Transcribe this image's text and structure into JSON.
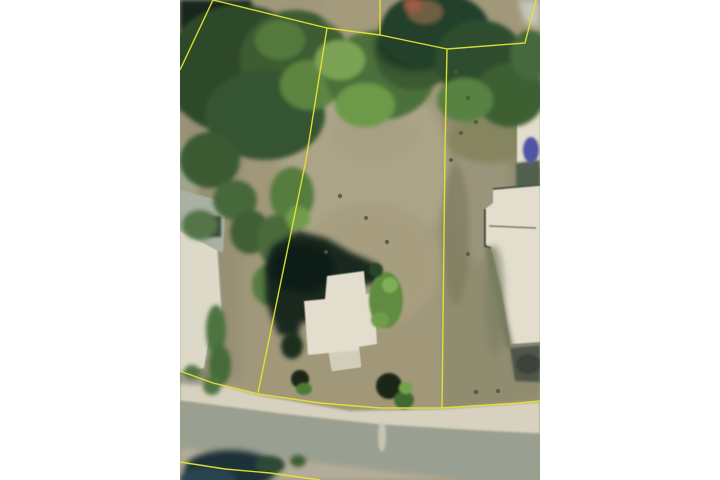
{
  "page": {
    "kind": "real-estate-listing-aerial-photo",
    "width": 720,
    "height": 480,
    "photo_frame": {
      "x": 180,
      "y": 0,
      "width": 360,
      "height": 480
    },
    "photo_alt": "aerial-satellite-view-of-vacant-lot-with-yellow-parcel-boundary-overlay"
  },
  "colors": {
    "page_bg": "#ffffff",
    "ground": "#a09879",
    "ground_light": "#aea68a",
    "ground_olive": "#8f8b6e",
    "tree_dark": "#2c4a2b",
    "tree_mid": "#4c6f3a",
    "tree_bright": "#6d9a49",
    "shadow_deep": "#15261a",
    "roof_white": "#e2ddcc",
    "concrete_gray": "#a9b1a3",
    "road_gray": "#99a092",
    "curb_light": "#d7d2c0",
    "shoulder_tan": "#b2ac9a",
    "bottom_trees_dark": "#1d3038",
    "driveway_dark": "#4f564c",
    "blue_object": "#4f55a5",
    "red_spot": "#a05a46",
    "parcel_line": "#e4e435"
  },
  "parcel_lines": [
    {
      "name": "top-left-arm",
      "points": [
        [
          33,
          0
        ],
        [
          0,
          70
        ]
      ]
    },
    {
      "name": "top-boundary",
      "points": [
        [
          33,
          0
        ],
        [
          147,
          28
        ],
        [
          200,
          35
        ],
        [
          267,
          49
        ],
        [
          345,
          43
        ],
        [
          356,
          0
        ]
      ]
    },
    {
      "name": "top-stub",
      "points": [
        [
          200,
          35
        ],
        [
          200,
          0
        ]
      ]
    },
    {
      "name": "left-boundary",
      "points": [
        [
          147,
          28
        ],
        [
          126,
          160
        ],
        [
          93,
          320
        ],
        [
          78,
          393
        ]
      ]
    },
    {
      "name": "left-entry",
      "points": [
        [
          0,
          371
        ],
        [
          33,
          383
        ],
        [
          78,
          394
        ]
      ]
    },
    {
      "name": "bottom-boundary",
      "points": [
        [
          78,
          394
        ],
        [
          140,
          403
        ],
        [
          200,
          408
        ],
        [
          262,
          408
        ],
        [
          340,
          403
        ],
        [
          360,
          401
        ]
      ]
    },
    {
      "name": "right-boundary",
      "points": [
        [
          267,
          49
        ],
        [
          265,
          150
        ],
        [
          263,
          320
        ],
        [
          262,
          408
        ]
      ]
    },
    {
      "name": "bottom-left-curve",
      "points": [
        [
          0,
          462
        ],
        [
          45,
          469
        ],
        [
          90,
          473
        ],
        [
          118,
          477
        ],
        [
          140,
          480
        ]
      ]
    }
  ]
}
